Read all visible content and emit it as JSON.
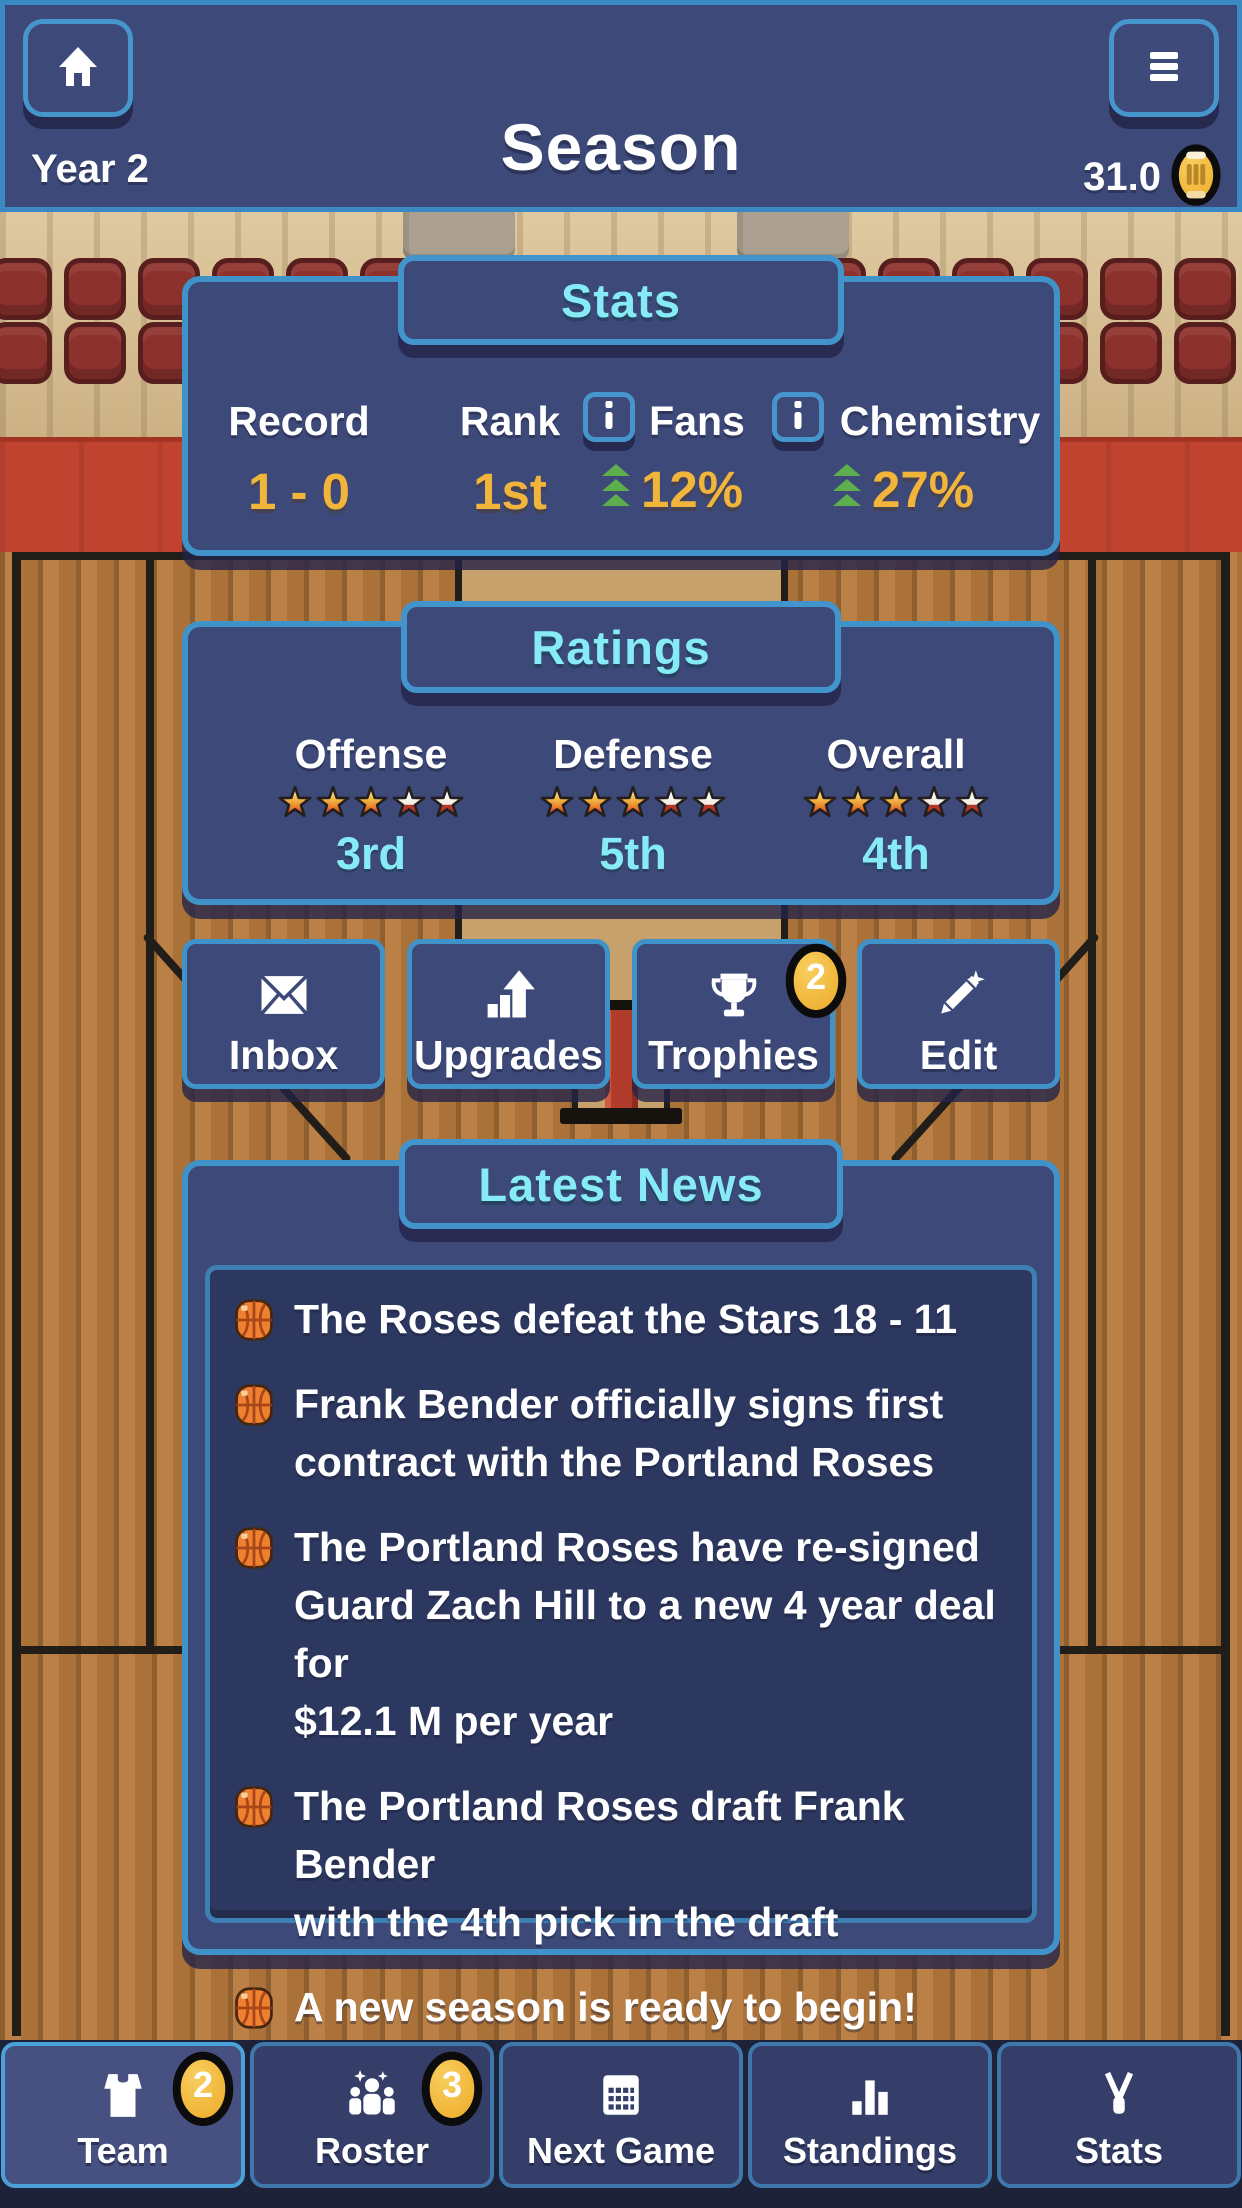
{
  "top_bar": {
    "title": "Season",
    "year_label": "Year 2",
    "currency_amount": "31.0",
    "home_icon": "home-icon",
    "menu_icon": "menu-icon",
    "coin_icon": "coin-icon"
  },
  "stats_panel": {
    "title": "Stats",
    "stats": [
      {
        "label": "Record",
        "value": "1 - 0"
      },
      {
        "label": "Rank",
        "value": "1st",
        "info": true
      },
      {
        "label": "Fans",
        "value": "12%",
        "info": true,
        "trend": "up"
      },
      {
        "label": "Chemistry",
        "value": "27%",
        "trend": "up"
      }
    ]
  },
  "ratings_panel": {
    "title": "Ratings",
    "ratings": [
      {
        "label": "Offense",
        "stars_filled": 3,
        "stars_total": 5,
        "rank": "3rd"
      },
      {
        "label": "Defense",
        "stars_filled": 3,
        "stars_total": 5,
        "rank": "5th"
      },
      {
        "label": "Overall",
        "stars_filled": 3,
        "stars_total": 5,
        "rank": "4th"
      }
    ]
  },
  "action_buttons": [
    {
      "label": "Inbox",
      "icon": "envelope-icon"
    },
    {
      "label": "Upgrades",
      "icon": "chart-up-icon"
    },
    {
      "label": "Trophies",
      "icon": "trophy-icon",
      "badge": "2"
    },
    {
      "label": "Edit",
      "icon": "pencil-icon"
    }
  ],
  "news_panel": {
    "title": "Latest News",
    "items": [
      {
        "text": "The Roses defeat the Stars 18 - 11"
      },
      {
        "text": "Frank Bender officially signs first\ncontract with the Portland Roses"
      },
      {
        "text": "The Portland Roses have re-signed\nGuard Zach Hill to a new 4 year deal for\n$12.1 M per year"
      },
      {
        "text": "The Portland Roses draft Frank Bender\nwith the 4th pick in the draft"
      },
      {
        "text": "A new season is ready to begin!"
      }
    ]
  },
  "bottom_nav": [
    {
      "label": "Team",
      "badge": "2",
      "active": true,
      "icon": "jersey-icon"
    },
    {
      "label": "Roster",
      "badge": "3",
      "icon": "people-icon"
    },
    {
      "label": "Next Game",
      "icon": "scoreboard-icon"
    },
    {
      "label": "Standings",
      "icon": "bar-chart-icon"
    },
    {
      "label": "Stats",
      "icon": "whistle-icon"
    }
  ],
  "colors": {
    "panel_navy": "#3d4979",
    "panel_border_blue": "#3f93c8",
    "accent_cyan": "#86ebf6",
    "accent_gold": "#f2b53c",
    "trend_green": "#5fae4e",
    "court_brown": "#b2783e",
    "court_key_tan": "#c7a16c",
    "band_red": "#c04330",
    "seat_maroon": "#8c312c",
    "news_inner_navy": "#2c3860"
  }
}
